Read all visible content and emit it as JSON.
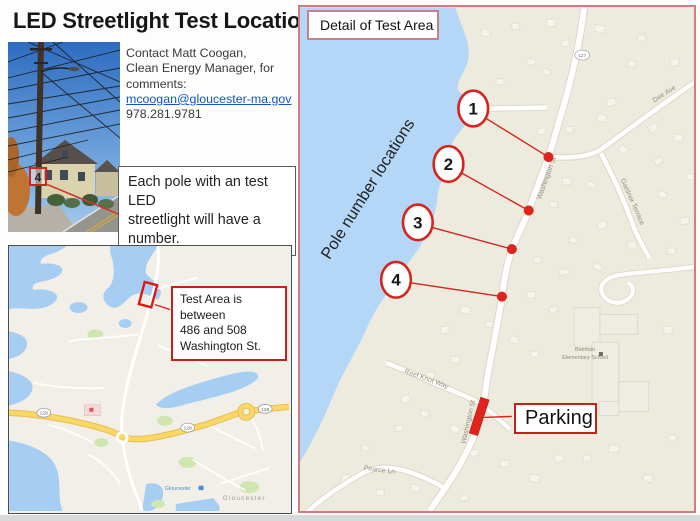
{
  "title": "LED Streetlight Test Locations",
  "contact": {
    "line1": "Contact Matt Coogan,",
    "line2": "Clean Energy Manager, for",
    "line3": "comments:",
    "email": "mcoogan@gloucester-ma.gov",
    "phone": "978.281.9781"
  },
  "note_box": {
    "line1": "Each pole with an test LED",
    "line2": "streetlight will have a",
    "underlined_word": "number",
    "suffix": "."
  },
  "photo": {
    "pole_tag": "4"
  },
  "overview_map": {
    "callout_line1": "Test Area is between",
    "callout_line2": "486 and 508",
    "callout_line3": "Washington St.",
    "city_label": "Gloucester",
    "station_label": "Gloucester",
    "route_shield": "128"
  },
  "detail_map": {
    "title": "Detail of Test Area",
    "rotated_label": "Pole number locations",
    "parking_label": "Parking",
    "route_shield": "127",
    "pole_markers": [
      "1",
      "2",
      "3",
      "4"
    ],
    "streets": {
      "washington_upper": "Washington St",
      "washington_lower": "Washington St",
      "dee_ave": "Dee Ave",
      "gardner_terrace": "Gardner Terrace",
      "reef_knot_way": "Reef Knot Way",
      "pearce_ln": "Pearce Ln"
    },
    "school_line1": "Beeman",
    "school_line2": "Elementary School"
  },
  "colors": {
    "accent_red": "#d8231d",
    "box_border_red": "#c6201a",
    "panel_border_pink": "#d47c7c",
    "water_detail": "#b4d7f7",
    "water_overview": "#a6cef2",
    "land_detail": "#edeade",
    "land_overview": "#f2efe8",
    "highway_yellow": "#f9d867",
    "link_blue": "#1155cc"
  }
}
